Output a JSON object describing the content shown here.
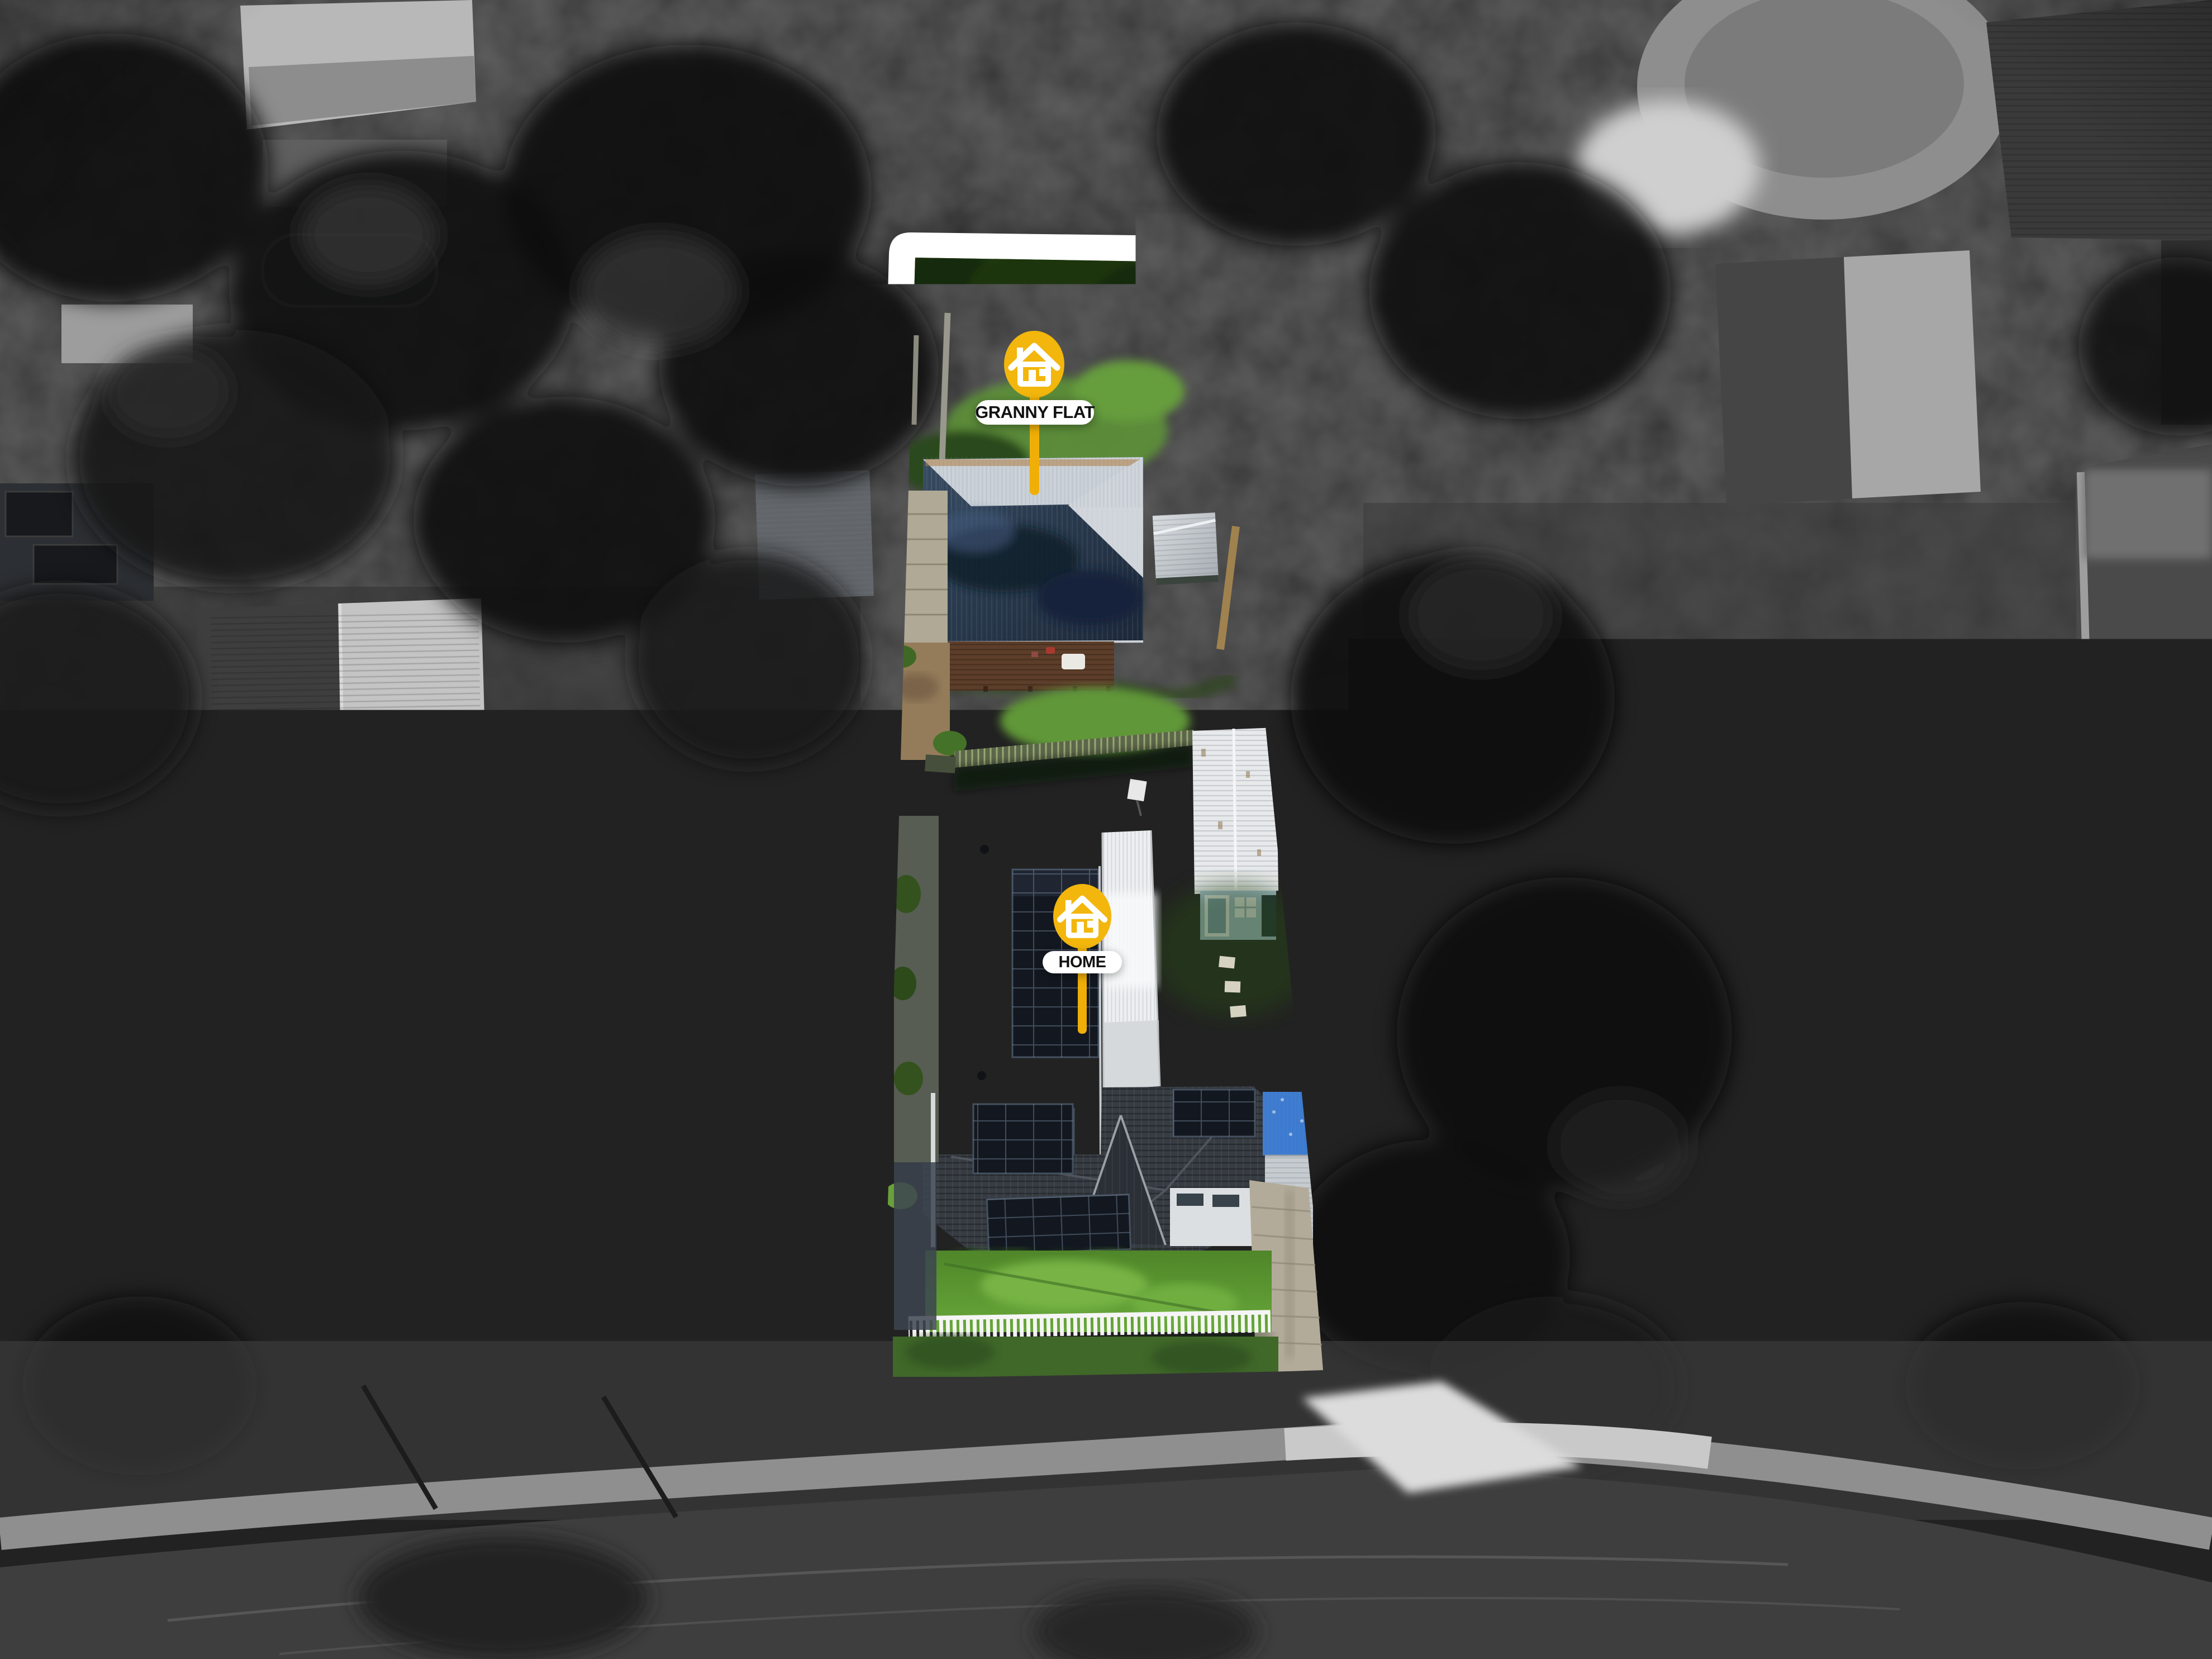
{
  "markers": [
    {
      "id": "granny-flat",
      "label": "GRANNY FLAT",
      "icon": "house-icon",
      "pin_color": "#F2B60D",
      "stick_color": "#EFAF08",
      "label_bg": "#FFFFFF",
      "label_text_color": "#111111"
    },
    {
      "id": "home",
      "label": "HOME",
      "icon": "house-icon",
      "pin_color": "#F2B60D",
      "stick_color": "#EFAF08",
      "label_bg": "#FFFFFF",
      "label_text_color": "#111111"
    }
  ],
  "palette": {
    "boundary_color": "#FFFFFF",
    "lawn_green": "#4C7A2D",
    "front_lawn_green": "#5F9B33",
    "granny_roof_blue": "#2C3E57",
    "roof_charcoal": "#373C43",
    "solar_panel": "#131820",
    "carport_blue": "#3B7BD2",
    "deck_brown": "#5C3E2A",
    "background_gray": "#222222"
  }
}
